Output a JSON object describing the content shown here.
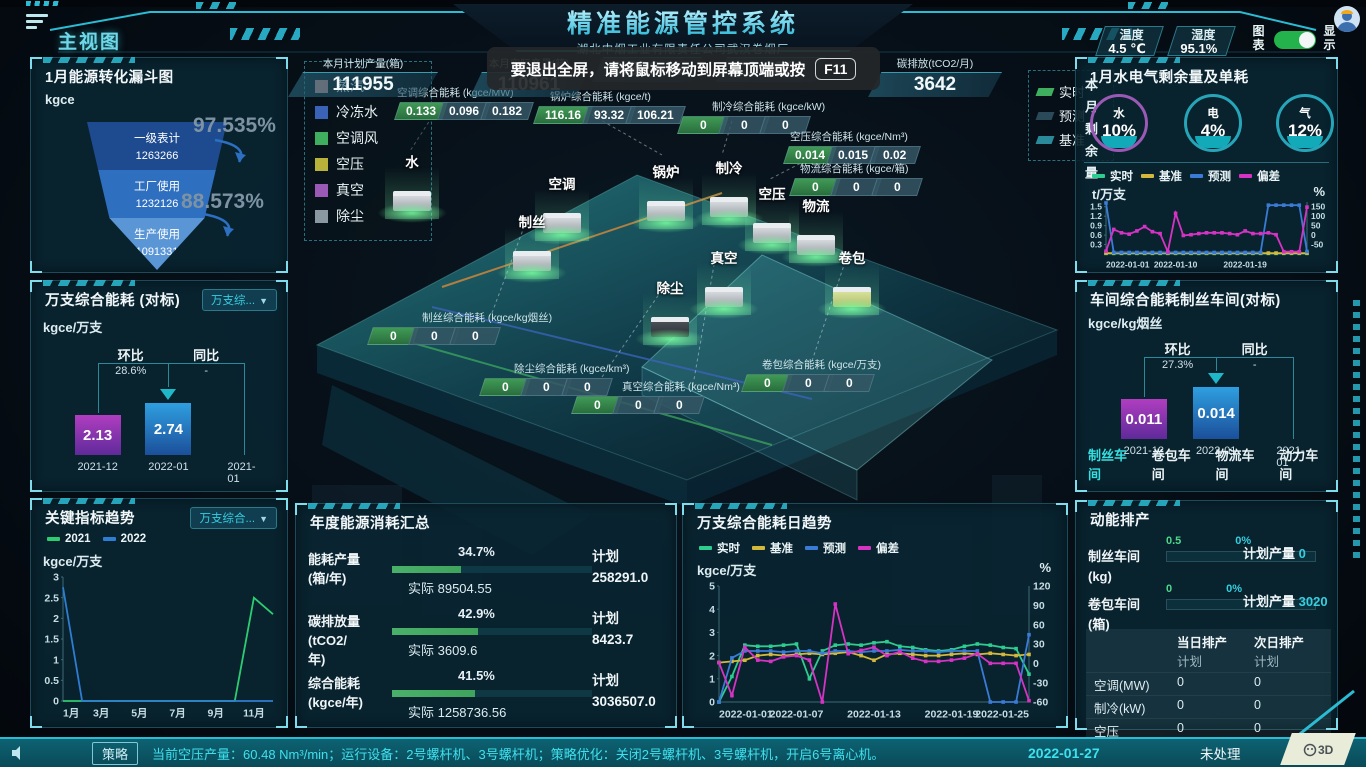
{
  "header": {
    "title": "精准能源管控系统",
    "subtitle": "湖北中烟工业有限责任公司武汉卷烟厂",
    "view_label": "主视图",
    "temperature": {
      "label": "温度",
      "value": "4.5 ℃"
    },
    "humidity": {
      "label": "湿度",
      "value": "95.1%"
    },
    "chart_toggle_label": "图表",
    "display_toggle_label": "显示"
  },
  "toast": {
    "message": "要退出全屏，请将鼠标移动到屏幕顶端或按",
    "key": "F11"
  },
  "stats_row": [
    {
      "label": "本月计划产量(箱)",
      "value": "111955"
    },
    {
      "label": "本月实际产量(箱)",
      "value": "110961"
    },
    {
      "label": "",
      "value": "0.888 %"
    },
    {
      "label": "",
      "value": "2.305"
    },
    {
      "label": "碳排放(tCO2/月)",
      "value": "3642"
    }
  ],
  "funnel_panel": {
    "title": "1月能源转化漏斗图",
    "unit": "kgce",
    "stages": [
      {
        "name": "一级表计",
        "value": "1263266",
        "color": "#1e4a8f"
      },
      {
        "name": "工厂使用",
        "value": "1232126",
        "color": "#2f6fc0"
      },
      {
        "name": "生产使用",
        "value": "1091331",
        "color": "#5a96d6"
      }
    ],
    "rates": [
      "97.535%",
      "88.573%"
    ]
  },
  "benchmark_panel": {
    "title": "万支综合能耗 (对标)",
    "dropdown": "万支综...",
    "unit": "kgce/万支",
    "mom_label": "环比",
    "mom_value": "28.6%",
    "yoy_label": "同比",
    "yoy_value": "-",
    "bars": [
      {
        "x": "2021-12",
        "value": "2.13",
        "kind": "purple",
        "h": 40
      },
      {
        "x": "2022-01",
        "value": "2.74",
        "kind": "blue",
        "h": 52
      },
      {
        "x": "2021-01",
        "value": "",
        "kind": "none",
        "h": 0
      }
    ]
  },
  "trend_panel": {
    "title": "关键指标趋势",
    "dropdown": "万支综合...",
    "unit": "kgce/万支",
    "legend": [
      {
        "name": "2021",
        "color": "#2ecc71"
      },
      {
        "name": "2022",
        "color": "#2d7dd2"
      }
    ],
    "chart": {
      "type": "line",
      "x": [
        "1月",
        "2月",
        "3月",
        "4月",
        "5月",
        "6月",
        "7月",
        "8月",
        "9月",
        "10月",
        "11月",
        "12月"
      ],
      "x_tick_idx": [
        0,
        2,
        4,
        6,
        8,
        10
      ],
      "ylim": [
        0,
        3
      ],
      "left_ticks": [
        0,
        0.5,
        1,
        1.5,
        2,
        2.5,
        3
      ],
      "series": [
        {
          "name": "2021",
          "color": "#2ecc71",
          "values": [
            0,
            0,
            0,
            0,
            0,
            0,
            0,
            0,
            0,
            0,
            2.5,
            2.1
          ]
        },
        {
          "name": "2022",
          "color": "#2d7dd2",
          "values": [
            2.75,
            0,
            0,
            0,
            0,
            0,
            0,
            0,
            0,
            0,
            0,
            0
          ]
        }
      ]
    }
  },
  "scene": {
    "legend": [
      {
        "name": "蒸汽",
        "color": "#c98a8a"
      },
      {
        "name": "冷冻水",
        "color": "#3a63b8"
      },
      {
        "name": "空调风",
        "color": "#3fae5f"
      },
      {
        "name": "空压",
        "color": "#b8b23a"
      },
      {
        "name": "真空",
        "color": "#9b59b6"
      },
      {
        "name": "除尘",
        "color": "#8a98a2"
      }
    ],
    "nodes": [
      "水",
      "空调",
      "制丝",
      "锅炉",
      "制冷",
      "空压",
      "物流",
      "真空",
      "除尘",
      "卷包"
    ],
    "strips": [
      {
        "title": "空调综合能耗 (kgce/MW)",
        "values": [
          "0.133",
          "0.096",
          "0.182"
        ]
      },
      {
        "title": "锅炉综合能耗 (kgce/t)",
        "values": [
          "116.16",
          "93.32",
          "106.21"
        ]
      },
      {
        "title": "制冷综合能耗 (kgce/kW)",
        "values": [
          "0",
          "0",
          "0"
        ]
      },
      {
        "title": "空压综合能耗 (kgce/Nm³)",
        "values": [
          "0.014",
          "0.015",
          "0.02"
        ]
      },
      {
        "title": "物流综合能耗 (kgce/箱)",
        "values": [
          "0",
          "0",
          "0"
        ]
      },
      {
        "title": "制丝综合能耗 (kgce/kg烟丝)",
        "values": [
          "0",
          "0",
          "0"
        ]
      },
      {
        "title": "除尘综合能耗 (kgce/km³)",
        "values": [
          "0",
          "0",
          "0"
        ]
      },
      {
        "title": "真空综合能耗 (kgce/Nm³)",
        "values": [
          "0",
          "0",
          "0"
        ]
      },
      {
        "title": "卷包综合能耗 (kgce/万支)",
        "values": [
          "0",
          "0",
          "0"
        ]
      }
    ],
    "hidden_legend": [
      {
        "name": "实时",
        "color": "#3fae5f"
      },
      {
        "name": "预测",
        "color": "#2a4a5a"
      },
      {
        "name": "基准",
        "color": "#2a8a9a"
      }
    ]
  },
  "water_panel": {
    "title": "1月水电气剩余量及单耗",
    "side_label": "本月剩余量",
    "gauges": [
      {
        "name": "水",
        "value": "10%",
        "ring": "#9b59b6"
      },
      {
        "name": "电",
        "value": "4%",
        "ring": "#27a5b8"
      },
      {
        "name": "气",
        "value": "12%",
        "ring": "#27a5b8"
      }
    ],
    "legend": [
      {
        "name": "实时",
        "color": "#2ecc8f"
      },
      {
        "name": "基准",
        "color": "#d4b83c"
      },
      {
        "name": "预测",
        "color": "#3a7bd5"
      },
      {
        "name": "偏差",
        "color": "#d633c4"
      }
    ],
    "unit_left": "t/万支",
    "unit_right": "%",
    "chart": {
      "type": "line",
      "x_labels": [
        "2022-01-01",
        "2022-01-10",
        "2022-01-19"
      ],
      "x_tick_idx": [
        0,
        9,
        18
      ],
      "n": 27,
      "ylim": [
        0,
        1.65
      ],
      "left_ticks": [
        0.3,
        0.6,
        0.9,
        1.2,
        1.5
      ],
      "right_lim": [
        -100,
        175
      ],
      "right_ticks": [
        -50,
        0,
        50,
        100,
        150
      ],
      "series": [
        {
          "name": "实时",
          "color": "#2ecc8f",
          "axis": "left",
          "values": [
            0.02,
            0.02,
            0.02,
            0.02,
            0.02,
            0.02,
            0.02,
            0.02,
            0.02,
            0.02,
            0.02,
            0.02,
            0.02,
            0.02,
            0.02,
            0.02,
            0.02,
            0.02,
            0.02,
            0.02,
            0.02,
            0.02,
            0.02,
            0.02,
            0.02,
            0.02,
            0.02
          ]
        },
        {
          "name": "基准",
          "color": "#d4b83c",
          "axis": "left",
          "values": [
            0.03,
            0.03,
            0.03,
            0.03,
            0.03,
            0.03,
            0.03,
            0.03,
            0.03,
            0.03,
            0.03,
            0.03,
            0.03,
            0.03,
            0.03,
            0.03,
            0.03,
            0.03,
            0.03,
            0.03,
            0.03,
            0.03,
            0.03,
            0.03,
            0.03,
            0.03,
            0.03
          ]
        },
        {
          "name": "预测",
          "color": "#3a7bd5",
          "axis": "left",
          "values": [
            1.62,
            0.05,
            0.05,
            0.05,
            0.05,
            0.05,
            0.05,
            0.05,
            0.05,
            0.05,
            0.05,
            0.05,
            0.05,
            0.05,
            0.05,
            0.05,
            0.05,
            0.05,
            0.05,
            0.05,
            0.05,
            1.55,
            1.55,
            1.55,
            1.55,
            1.55,
            0.08
          ]
        },
        {
          "name": "偏差",
          "color": "#d633c4",
          "axis": "right",
          "values": [
            -85,
            30,
            12,
            5,
            22,
            45,
            18,
            8,
            -88,
            115,
            -2,
            2,
            8,
            12,
            12,
            12,
            8,
            2,
            22,
            8,
            8,
            12,
            2,
            -88,
            -88,
            -88,
            148
          ]
        }
      ]
    }
  },
  "workshop_panel": {
    "title": "车间综合能耗制丝车间(对标)",
    "unit": "kgce/kg烟丝",
    "mom_label": "环比",
    "mom_value": "27.3%",
    "yoy_label": "同比",
    "yoy_value": "-",
    "bars": [
      {
        "x": "2021-12",
        "value": "0.011",
        "kind": "purple",
        "h": 40
      },
      {
        "x": "2022-01",
        "value": "0.014",
        "kind": "blue",
        "h": 52
      },
      {
        "x": "2021-01",
        "value": "",
        "kind": "none",
        "h": 0
      }
    ],
    "tabs": [
      "制丝车间",
      "卷包车间",
      "物流车间",
      "动力车间"
    ],
    "active_tab": 0
  },
  "annual_panel": {
    "title": "年度能源消耗汇总",
    "plan_label": "计划",
    "rows": [
      {
        "label": "能耗产量\n(箱/年)",
        "percent": "34.7%",
        "pct": 34.7,
        "actual": "实际 89504.55",
        "plan": "258291.0"
      },
      {
        "label": "碳排放量\n(tCO2/\n年)",
        "percent": "42.9%",
        "pct": 42.9,
        "actual": "实际 3609.6",
        "plan": "8423.7"
      },
      {
        "label": "综合能耗\n(kgce/年)",
        "percent": "41.5%",
        "pct": 41.5,
        "actual": "实际 1258736.56",
        "plan": "3036507.0"
      }
    ]
  },
  "daily_panel": {
    "title": "万支综合能耗日趋势",
    "legend": [
      {
        "name": "实时",
        "color": "#2ecc8f"
      },
      {
        "name": "基准",
        "color": "#d4b83c"
      },
      {
        "name": "预测",
        "color": "#3a7bd5"
      },
      {
        "name": "偏差",
        "color": "#d633c4"
      }
    ],
    "unit_left": "kgce/万支",
    "unit_right": "%",
    "chart": {
      "type": "line",
      "x_labels": [
        "2022-01-01",
        "2022-01-07",
        "2022-01-13",
        "2022-01-19",
        "2022-01-25"
      ],
      "x_tick_idx": [
        0,
        6,
        12,
        18,
        24
      ],
      "n": 25,
      "ylim": [
        0,
        5
      ],
      "left_ticks": [
        0,
        1,
        2,
        3,
        4,
        5
      ],
      "right_lim": [
        -60,
        120
      ],
      "right_ticks": [
        -60,
        -30,
        0,
        30,
        60,
        90,
        120
      ],
      "series": [
        {
          "name": "实时",
          "color": "#2ecc8f",
          "axis": "left",
          "values": [
            0,
            1.1,
            2.45,
            2.4,
            2.4,
            2.45,
            2.5,
            1.0,
            2.2,
            2.45,
            2.5,
            2.45,
            2.55,
            2.6,
            2.4,
            2.35,
            2.25,
            2.2,
            2.25,
            2.4,
            2.5,
            2.45,
            2.35,
            2.3,
            1.2
          ]
        },
        {
          "name": "基准",
          "color": "#d4b83c",
          "axis": "left",
          "values": [
            1.7,
            1.75,
            1.8,
            2.0,
            2.05,
            2.0,
            2.05,
            2.1,
            2.05,
            2.1,
            2.15,
            2.0,
            1.8,
            2.05,
            2.1,
            2.05,
            2.0,
            2.0,
            2.05,
            2.1,
            2.05,
            2.1,
            2.05,
            2.0,
            2.05
          ]
        },
        {
          "name": "预测",
          "color": "#3a7bd5",
          "axis": "left",
          "values": [
            0,
            1.9,
            2.2,
            2.2,
            2.2,
            2.15,
            2.2,
            2.2,
            2.1,
            2.2,
            2.2,
            2.15,
            2.2,
            2.2,
            2.25,
            2.2,
            2.2,
            2.15,
            2.2,
            2.2,
            2.2,
            0,
            0,
            0,
            2.9
          ]
        },
        {
          "name": "偏差",
          "color": "#d633c4",
          "axis": "right",
          "values": [
            1,
            -50,
            25,
            5,
            3,
            10,
            12,
            5,
            -60,
            92,
            15,
            20,
            25,
            12,
            18,
            8,
            3,
            3,
            5,
            8,
            15,
            0,
            0,
            0,
            -58
          ]
        }
      ]
    }
  },
  "schedule_panel": {
    "title": "动能排产",
    "rows": [
      {
        "name": "制丝车间",
        "unit": "(kg)",
        "left_value": "0.5",
        "pct": "0%",
        "plan_label": "计划产量",
        "plan": "0"
      },
      {
        "name": "卷包车间",
        "unit": "(箱)",
        "left_value": "0",
        "pct": "0%",
        "plan_label": "计划产量",
        "plan": "3020"
      }
    ],
    "table": {
      "col_headers": [
        "当日排产",
        "次日排产"
      ],
      "col_sub": "计划",
      "rows": [
        [
          "空调(MW)",
          "0",
          "0"
        ],
        [
          "制冷(kW)",
          "0",
          "0"
        ],
        [
          "空压",
          "0",
          "0"
        ],
        [
          "真空",
          "0",
          "0"
        ],
        [
          "锅炉(t)",
          "0",
          "0"
        ]
      ]
    }
  },
  "footer": {
    "badge": "策略",
    "message": "当前空压产量：60.48 Nm³/min；运行设备：2号螺杆机、3号螺杆机；策略优化：关闭2号螺杆机、3号螺杆机，开启6号离心机。",
    "date": "2022-01-27",
    "status": "未处理",
    "badge_3d": "3D"
  },
  "colors": {
    "accent": "#35cfe0",
    "panel_bg": "#092632",
    "bar_purple": "#a83ec0",
    "bar_blue": "#2f9fe0",
    "progress_green": "#3fa45c",
    "toggle_green": "#24b24c"
  }
}
